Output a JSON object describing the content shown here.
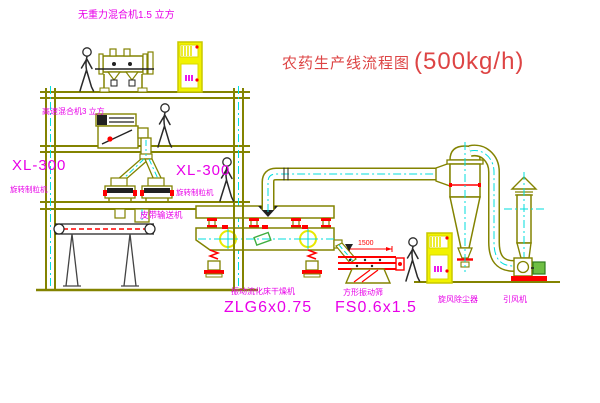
{
  "title": {
    "text": "农药生产线流程图",
    "capacity": "(500kg/h)",
    "color": "#dd4444"
  },
  "labels": {
    "mixer_top": "无重力混合机1.5 立方",
    "mixer_mid": "高速混合机3 立方",
    "granulator_left_model": "XL-300",
    "granulator_left_name": "旋转制粒机",
    "granulator_right_model": "XL-300",
    "granulator_right_name": "旋转制粒机",
    "belt_conveyor": "皮带输送机",
    "dryer_name": "振动流化床干燥机",
    "dryer_model": "ZLG6x0.75",
    "screen_name": "方形振动筛",
    "screen_model": "FS0.6x1.5",
    "screen_dimension": "1500",
    "cyclone": "旋风除尘器",
    "fan": "引风机"
  },
  "colors": {
    "equipment_outline": "#838300",
    "centerline": "#00dede",
    "label": "#e800e8",
    "highlight": "#ff0000",
    "cabinet": "#f2f200",
    "title": "#dd4444"
  },
  "icons": {
    "people_figures": 4,
    "control_cabinets": 2
  }
}
